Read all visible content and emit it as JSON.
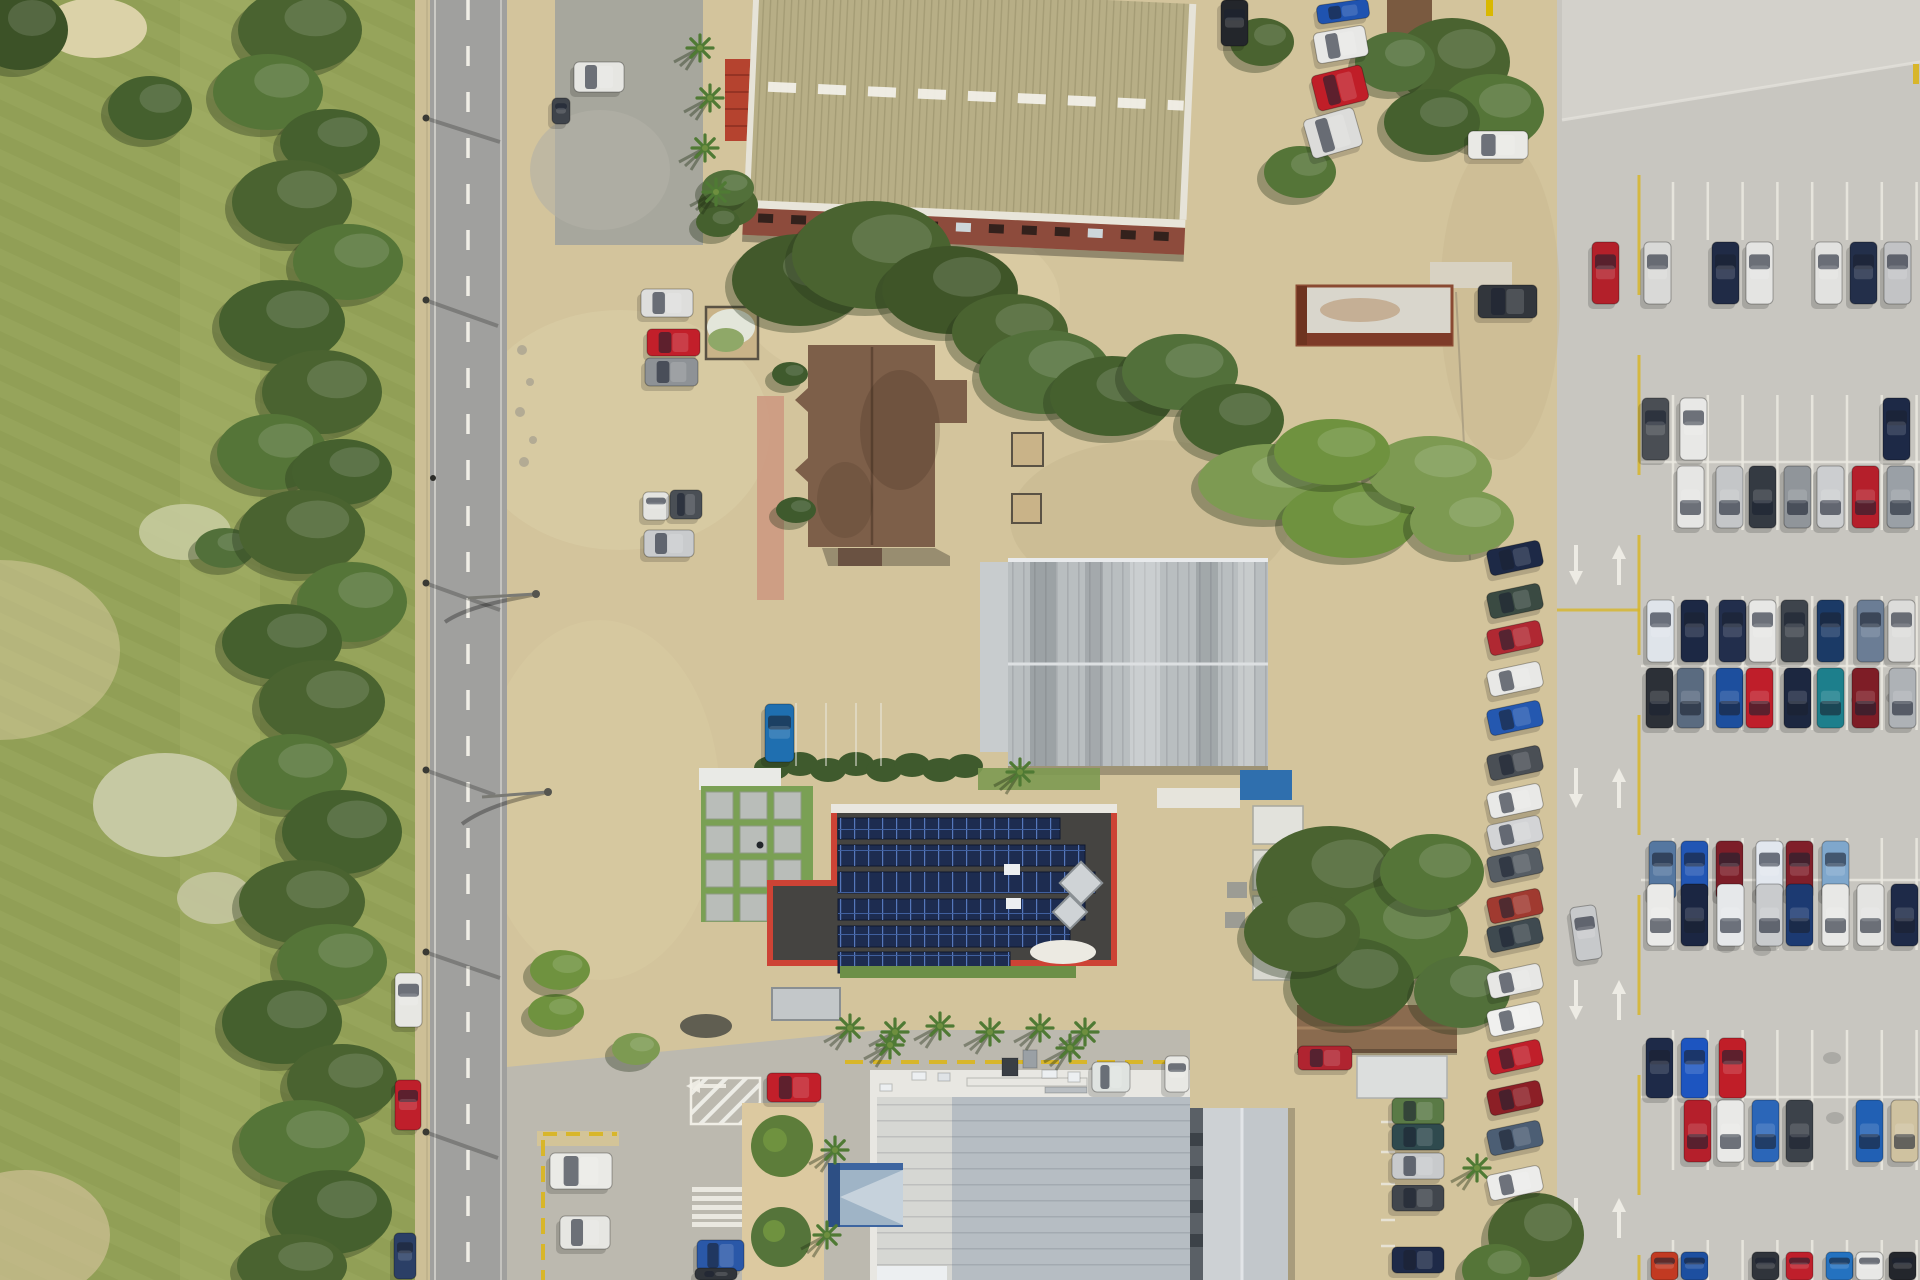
{
  "scene": {
    "kind": "aerial-top-down-photograph",
    "setting": "commercial lots beside a two-lane road, golf course at left, large car park at right"
  },
  "palette": {
    "golf_grass": "#95a35a",
    "golf_stripe": "#8d9c52",
    "rough": "#a7b169",
    "dirt": "#d3c49c",
    "dirt_light": "#e0d2ab",
    "dirt_dark": "#c3b48c",
    "road_asphalt": "#a0a09e",
    "concrete_lot": "#c8c6c0",
    "concrete_light": "#d3d1cb",
    "tree_dark": "#45602e",
    "tree_mid": "#5a7a3a",
    "tree_light": "#7d9a52",
    "hall_roof_khaki": "#b7ae86",
    "hall_wall_red": "#8d4b3c",
    "red_shed": "#b5432f",
    "brown_house_roof": "#7d5f49",
    "warehouse_gray": "#b9bec0",
    "solar_border_red": "#cd4335",
    "solar_deck": "#454441",
    "solar_panel_blue": "#1d2c50",
    "retail_white_band": "#e8e7e2",
    "retail_roof_blue_gray": "#b6bdc3",
    "retail_roof_light": "#d6d7d3",
    "entrance_canopy_blue": "#3d65a0",
    "gable_building_gray": "#cdd1d4",
    "brown_gable_roof": "#8a6b4f",
    "marking_white": "#eceae2",
    "marking_yellow": "#d8b62a",
    "hedge_green": "#3f5a2d",
    "lawn_green": "#7aa054",
    "path_pink": "#cd9a82"
  },
  "counts": {
    "right_lot_cars": 58,
    "left_column_cars": 17,
    "roadside_cars": 3
  },
  "solar_rows": [
    [
      838,
      818,
      222
    ],
    [
      838,
      845,
      247
    ],
    [
      838,
      872,
      257
    ],
    [
      838,
      899,
      247
    ],
    [
      838,
      926,
      232
    ],
    [
      838,
      952,
      172
    ]
  ],
  "hall_windows": {
    "start_x": 768,
    "step": 33,
    "count": 13,
    "y": 213,
    "w": 15,
    "h": 9
  },
  "pavers": {
    "x": 706,
    "y": 792,
    "cols": 3,
    "rows": 4,
    "size": 27,
    "gap": 7
  },
  "stall_sets": [
    {
      "x0": 1673,
      "n": 8,
      "pitch": 34.8,
      "y1": 182,
      "y2": 240
    },
    {
      "x0": 1673,
      "n": 8,
      "pitch": 34.8,
      "y1": 395,
      "y2": 530,
      "head": 462
    },
    {
      "x0": 1673,
      "n": 8,
      "pitch": 34.8,
      "y1": 596,
      "y2": 730,
      "head": 666
    },
    {
      "x0": 1673,
      "n": 8,
      "pitch": 34.8,
      "y1": 838,
      "y2": 950,
      "head": 880
    },
    {
      "x0": 1673,
      "n": 8,
      "pitch": 34.8,
      "y1": 1030,
      "y2": 1170,
      "head": 1097
    },
    {
      "x0": 1673,
      "n": 8,
      "pitch": 34.8,
      "y1": 1240,
      "y2": 1280
    }
  ],
  "mini_stalls": {
    "x": 1381,
    "len": 14,
    "ys": [
      1122,
      1152,
      1184,
      1220,
      1246
    ]
  },
  "faint_stalls": {
    "xs": [
      796,
      826,
      856,
      881
    ],
    "y1": 703,
    "y2": 766
  },
  "aisle_arrows": [
    [
      1576,
      545,
      "d"
    ],
    [
      1619,
      545,
      "u"
    ],
    [
      1576,
      768,
      "d"
    ],
    [
      1619,
      768,
      "u"
    ],
    [
      1576,
      980,
      "d"
    ],
    [
      1619,
      980,
      "u"
    ],
    [
      1576,
      1198,
      "d"
    ],
    [
      1619,
      1198,
      "u"
    ],
    [
      700,
      1086,
      "l"
    ]
  ],
  "right_lot_rows": [
    {
      "y": 242,
      "h": 62,
      "dir": "u",
      "cars": [
        [
          1592,
          "#b3202a"
        ],
        [
          1644,
          "#d9d9d7"
        ],
        [
          1712,
          "#202b46"
        ],
        [
          1746,
          "#e4e4e2"
        ],
        [
          1815,
          "#e2e2e0"
        ],
        [
          1850,
          "#232f4a"
        ],
        [
          1884,
          "#c2c3c5"
        ]
      ]
    },
    {
      "y": 398,
      "h": 62,
      "dir": "u",
      "cars": [
        [
          1642,
          "#4a4e54"
        ],
        [
          1680,
          "#e8e8e6"
        ],
        [
          1883,
          "#1d2946"
        ]
      ]
    },
    {
      "y": 466,
      "h": 62,
      "dir": "d",
      "cars": [
        [
          1677,
          "#e6e6e4"
        ],
        [
          1716,
          "#c4c6c8"
        ],
        [
          1749,
          "#343a42"
        ],
        [
          1784,
          "#90959a"
        ],
        [
          1817,
          "#ccced0"
        ],
        [
          1852,
          "#b51f2b"
        ],
        [
          1887,
          "#9aa0a6"
        ]
      ]
    },
    {
      "y": 600,
      "h": 62,
      "dir": "u",
      "cars": [
        [
          1647,
          "#dfe4ea"
        ],
        [
          1681,
          "#1c2844"
        ],
        [
          1719,
          "#222e4c"
        ],
        [
          1749,
          "#e7e7e5"
        ],
        [
          1781,
          "#3e444c"
        ],
        [
          1817,
          "#1b3a66"
        ],
        [
          1857,
          "#6b7d95"
        ],
        [
          1888,
          "#dcdcda"
        ]
      ]
    },
    {
      "y": 668,
      "h": 60,
      "dir": "d",
      "cars": [
        [
          1646,
          "#2c3037"
        ],
        [
          1677,
          "#5a6b80"
        ],
        [
          1716,
          "#1d4f9e"
        ],
        [
          1746,
          "#bf1e2a"
        ],
        [
          1784,
          "#1c2740"
        ],
        [
          1817,
          "#1d7f8c"
        ],
        [
          1852,
          "#7e1d26"
        ],
        [
          1889,
          "#aeb2b6"
        ]
      ]
    },
    {
      "y": 841,
      "h": 58,
      "dir": "u",
      "cars": [
        [
          1649,
          "#5577a0"
        ],
        [
          1681,
          "#2256b4"
        ],
        [
          1716,
          "#7c1e28"
        ],
        [
          1756,
          "#e2e7ee"
        ],
        [
          1786,
          "#801f2a"
        ],
        [
          1822,
          "#7fa7cc"
        ]
      ]
    },
    {
      "y": 884,
      "h": 62,
      "dir": "d",
      "cars": [
        [
          1647,
          "#eaeae8"
        ],
        [
          1681,
          "#1b2642"
        ],
        [
          1717,
          "#e6e8ea"
        ],
        [
          1756,
          "#c9cbcd"
        ],
        [
          1786,
          "#1c3a72"
        ],
        [
          1822,
          "#e8e8e6"
        ],
        [
          1857,
          "#e4e4e2"
        ],
        [
          1891,
          "#1e2a48"
        ]
      ]
    },
    {
      "y": 1038,
      "h": 60,
      "dir": "u",
      "cars": [
        [
          1646,
          "#1e2a48"
        ],
        [
          1681,
          "#1d55c0"
        ],
        [
          1719,
          "#c01e28"
        ]
      ]
    },
    {
      "y": 1100,
      "h": 62,
      "dir": "d",
      "cars": [
        [
          1684,
          "#b51f2b"
        ],
        [
          1717,
          "#e9e9e7"
        ],
        [
          1752,
          "#2b66b8"
        ],
        [
          1786,
          "#3c424a"
        ],
        [
          1856,
          "#2160b4"
        ],
        [
          1891,
          "#cfc2a0"
        ]
      ]
    },
    {
      "y": 1252,
      "h": 28,
      "dir": "u",
      "cars": [
        [
          1651,
          "#c23a22"
        ],
        [
          1681,
          "#1d4fa0"
        ],
        [
          1752,
          "#30343b"
        ],
        [
          1786,
          "#bf1f2b"
        ],
        [
          1826,
          "#2472c0"
        ],
        [
          1856,
          "#e8e8e6"
        ],
        [
          1889,
          "#23262c"
        ]
      ]
    }
  ],
  "left_column": {
    "x": 1488,
    "w": 54,
    "h": 26,
    "rot": -12,
    "cars": [
      [
        545,
        "#1d2946"
      ],
      [
        588,
        "#3a4a42"
      ],
      [
        625,
        "#b02832"
      ],
      [
        666,
        "#e8e8e6"
      ],
      [
        705,
        "#2458b0"
      ],
      [
        750,
        "#4a4f55"
      ],
      [
        788,
        "#e9e9e7"
      ],
      [
        820,
        "#d3d4d6"
      ],
      [
        852,
        "#565d64"
      ],
      [
        893,
        "#a03a30"
      ],
      [
        922,
        "#3f4a50"
      ],
      [
        968,
        "#e7e7e5"
      ],
      [
        1006,
        "#f0f0ee"
      ],
      [
        1044,
        "#c01f2a"
      ],
      [
        1085,
        "#8c1f26"
      ],
      [
        1125,
        "#4c5e74"
      ],
      [
        1170,
        "#ececea"
      ]
    ]
  },
  "mid_column": {
    "x": 1392,
    "w": 52,
    "h": 26,
    "cars": [
      [
        1098,
        "#5a7a46"
      ],
      [
        1124,
        "#2f4a4e"
      ],
      [
        1153,
        "#c8cacc"
      ],
      [
        1185,
        "#41464d"
      ],
      [
        1247,
        "#1e2a48"
      ]
    ]
  },
  "scattered_cars": [
    [
      574,
      62,
      50,
      30,
      0,
      "#e6e6e2"
    ],
    [
      552,
      98,
      18,
      26,
      0,
      "#3f444b"
    ],
    [
      641,
      289,
      52,
      28,
      0,
      "#dededc"
    ],
    [
      647,
      329,
      53,
      27,
      0,
      "#c21f2a"
    ],
    [
      645,
      358,
      53,
      28,
      0,
      "#8e9296"
    ],
    [
      643,
      492,
      26,
      28,
      0,
      "#e4e4e0"
    ],
    [
      670,
      490,
      32,
      29,
      0,
      "#4a4f55"
    ],
    [
      644,
      530,
      50,
      27,
      0,
      "#c9cbcd"
    ],
    [
      765,
      704,
      29,
      58,
      0,
      "#1f6fb0"
    ],
    [
      1221,
      0,
      27,
      46,
      0,
      "#23262b"
    ],
    [
      1317,
      2,
      52,
      19,
      -8,
      "#1f53b0"
    ],
    [
      1315,
      29,
      52,
      31,
      -10,
      "#e8e8e6"
    ],
    [
      1314,
      70,
      52,
      36,
      -14,
      "#c01e28"
    ],
    [
      1307,
      113,
      52,
      40,
      -16,
      "#dcdcda"
    ],
    [
      1468,
      131,
      60,
      28,
      0,
      "#e9e9e5"
    ],
    [
      1478,
      285,
      59,
      33,
      0,
      "#32363c"
    ],
    [
      395,
      973,
      27,
      54,
      0,
      "#e7e7e3"
    ],
    [
      395,
      1080,
      26,
      50,
      0,
      "#bf1f2b"
    ],
    [
      394,
      1233,
      22,
      46,
      0,
      "#2b3f66"
    ],
    [
      550,
      1153,
      62,
      36,
      0,
      "#eaeae6"
    ],
    [
      560,
      1216,
      50,
      33,
      0,
      "#e6e6e2"
    ],
    [
      697,
      1240,
      47,
      31,
      0,
      "#2a58a8"
    ],
    [
      695,
      1268,
      42,
      12,
      0,
      "#30343a"
    ],
    [
      767,
      1073,
      54,
      29,
      0,
      "#c21f2a"
    ],
    [
      1298,
      1046,
      54,
      24,
      0,
      "#b02430"
    ],
    [
      1092,
      1062,
      38,
      30,
      0,
      "#dfe3e0"
    ],
    [
      1165,
      1056,
      24,
      36,
      0,
      "#e8e8e4"
    ],
    [
      1573,
      906,
      26,
      54,
      -8,
      "#c7c9cb"
    ]
  ],
  "trees": [
    [
      20,
      30,
      48,
      40,
      "#3c5227"
    ],
    [
      150,
      108,
      42,
      32,
      "#45602e"
    ],
    [
      225,
      548,
      30,
      20,
      "#52703a"
    ],
    [
      300,
      30,
      62,
      42,
      "#4a6330"
    ],
    [
      268,
      92,
      55,
      38,
      "#557538"
    ],
    [
      330,
      142,
      50,
      33,
      "#45602e"
    ],
    [
      292,
      202,
      60,
      42,
      "#4a6330"
    ],
    [
      348,
      262,
      55,
      38,
      "#557538"
    ],
    [
      282,
      322,
      63,
      42,
      "#45602e"
    ],
    [
      322,
      392,
      60,
      42,
      "#4a6330"
    ],
    [
      272,
      452,
      55,
      38,
      "#557538"
    ],
    [
      342,
      472,
      50,
      33,
      "#45602e"
    ],
    [
      302,
      532,
      63,
      42,
      "#4a6330"
    ],
    [
      352,
      602,
      55,
      40,
      "#557538"
    ],
    [
      282,
      642,
      60,
      38,
      "#45602e"
    ],
    [
      322,
      702,
      63,
      42,
      "#4a6330"
    ],
    [
      292,
      772,
      55,
      38,
      "#557538"
    ],
    [
      342,
      832,
      60,
      42,
      "#45602e"
    ],
    [
      302,
      902,
      63,
      42,
      "#4a6330"
    ],
    [
      332,
      962,
      55,
      38,
      "#557538"
    ],
    [
      282,
      1022,
      60,
      42,
      "#45602e"
    ],
    [
      342,
      1082,
      55,
      38,
      "#4a6330"
    ],
    [
      302,
      1142,
      63,
      42,
      "#557538"
    ],
    [
      332,
      1212,
      60,
      42,
      "#45602e"
    ],
    [
      292,
      1266,
      55,
      32,
      "#4a6330"
    ],
    [
      800,
      280,
      68,
      46,
      "#42592b"
    ],
    [
      872,
      255,
      80,
      54,
      "#4a6330"
    ],
    [
      950,
      290,
      68,
      44,
      "#3f5528"
    ],
    [
      1010,
      332,
      58,
      38,
      "#4a6330"
    ],
    [
      1045,
      372,
      66,
      42,
      "#52703a"
    ],
    [
      1112,
      396,
      62,
      40,
      "#45602e"
    ],
    [
      1180,
      372,
      58,
      38,
      "#52703a"
    ],
    [
      1232,
      420,
      52,
      36,
      "#45602e"
    ],
    [
      1270,
      482,
      72,
      38,
      "#7d9a52"
    ],
    [
      1350,
      520,
      68,
      38,
      "#6f923f"
    ],
    [
      1430,
      472,
      62,
      36,
      "#7d9a52"
    ],
    [
      1332,
      452,
      58,
      33,
      "#6f923f"
    ],
    [
      1462,
      522,
      52,
      33,
      "#7d9a52"
    ],
    [
      1452,
      62,
      58,
      44,
      "#4a6330"
    ],
    [
      1492,
      112,
      52,
      38,
      "#557538"
    ],
    [
      1432,
      122,
      48,
      33,
      "#45602e"
    ],
    [
      1395,
      62,
      40,
      30,
      "#52703a"
    ],
    [
      1300,
      172,
      36,
      26,
      "#557538"
    ],
    [
      1262,
      42,
      32,
      24,
      "#4a6330"
    ],
    [
      1330,
      880,
      74,
      54,
      "#4a6330"
    ],
    [
      1400,
      932,
      68,
      48,
      "#557538"
    ],
    [
      1352,
      982,
      62,
      44,
      "#45602e"
    ],
    [
      1302,
      932,
      58,
      40,
      "#4a6330"
    ],
    [
      1432,
      872,
      52,
      38,
      "#557538"
    ],
    [
      1462,
      992,
      48,
      36,
      "#52703a"
    ],
    [
      1536,
      1235,
      48,
      42,
      "#4a6330"
    ],
    [
      1496,
      1270,
      34,
      26,
      "#557538"
    ],
    [
      556,
      1012,
      28,
      18,
      "#6f923f"
    ],
    [
      636,
      1049,
      24,
      16,
      "#7d9a52"
    ],
    [
      560,
      970,
      30,
      20,
      "#6f923f"
    ],
    [
      728,
      188,
      26,
      18,
      "#52703a"
    ],
    [
      718,
      222,
      22,
      15,
      "#45602e"
    ],
    [
      790,
      374,
      18,
      12,
      "#3f5a2d"
    ],
    [
      796,
      510,
      20,
      13,
      "#3f5a2d"
    ]
  ],
  "palms": [
    [
      850,
      1028
    ],
    [
      895,
      1032
    ],
    [
      940,
      1026
    ],
    [
      990,
      1032
    ],
    [
      1040,
      1028
    ],
    [
      1085,
      1032
    ],
    [
      835,
      1150
    ],
    [
      827,
      1235
    ],
    [
      1020,
      772
    ],
    [
      700,
      48
    ],
    [
      710,
      98
    ],
    [
      705,
      148
    ],
    [
      716,
      192
    ],
    [
      890,
      1045
    ],
    [
      1070,
      1048
    ],
    [
      1477,
      1168
    ]
  ],
  "hedge_blobs": [
    [
      772,
      768
    ],
    [
      800,
      764
    ],
    [
      828,
      770
    ],
    [
      856,
      764
    ],
    [
      884,
      770
    ],
    [
      912,
      765
    ],
    [
      940,
      770
    ],
    [
      965,
      766
    ]
  ],
  "rooftop_units": [
    [
      967,
      1078,
      120,
      8,
      "#e8e7e2"
    ],
    [
      1045,
      1087,
      42,
      6,
      "#b9bec2"
    ],
    [
      1002,
      1058,
      16,
      18,
      "#3a3f45"
    ],
    [
      1023,
      1050,
      14,
      18,
      "#9aa0a5"
    ],
    [
      1042,
      1070,
      15,
      8,
      "#eceff1"
    ],
    [
      1068,
      1072,
      12,
      10,
      "#eceff1"
    ],
    [
      1098,
      1070,
      17,
      12,
      "#eceff1"
    ],
    [
      912,
      1072,
      14,
      8,
      "#eceff1"
    ],
    [
      938,
      1073,
      12,
      8,
      "#dfe3e6"
    ],
    [
      880,
      1084,
      12,
      7,
      "#eceff1"
    ]
  ],
  "oil_stains": [
    [
      1800,
      1120
    ],
    [
      1835,
      1118
    ],
    [
      1870,
      1114
    ],
    [
      1795,
      500
    ],
    [
      1832,
      1058
    ],
    [
      1726,
      947
    ],
    [
      1762,
      950
    ],
    [
      1860,
      700
    ],
    [
      1895,
      698
    ]
  ]
}
